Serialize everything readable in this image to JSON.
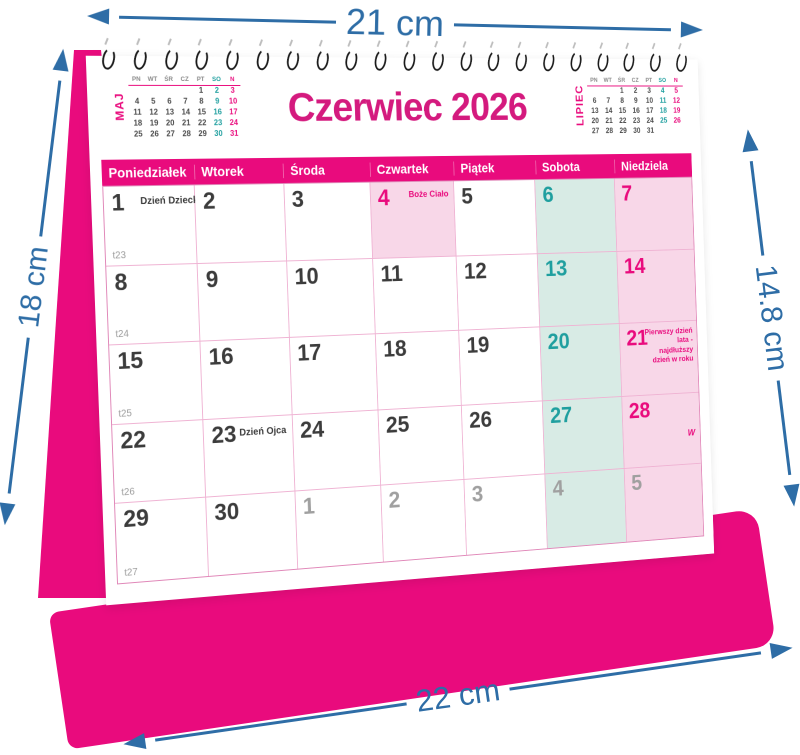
{
  "annotations": {
    "top": "21 cm",
    "left": "18 cm",
    "right": "14.8 cm",
    "bottom": "22 cm",
    "arrow_color": "#2e6da6"
  },
  "calendar": {
    "title": "Czerwiec 2026",
    "weekdays": [
      "Poniedziałek",
      "Wtorek",
      "Środa",
      "Czwartek",
      "Piątek",
      "Sobota",
      "Niedziela"
    ],
    "week_numbers": [
      "t23",
      "t24",
      "t25",
      "t26",
      "t27"
    ],
    "spiral_loops": 21,
    "mini_prev": {
      "label": "MAJ",
      "headers": [
        "PN",
        "WT",
        "ŚR",
        "CZ",
        "PT",
        "SO",
        "N"
      ],
      "days": [
        "",
        "",
        "",
        "",
        "1",
        "2",
        "3",
        "4",
        "5",
        "6",
        "7",
        "8",
        "9",
        "10",
        "11",
        "12",
        "13",
        "14",
        "15",
        "16",
        "17",
        "18",
        "19",
        "20",
        "21",
        "22",
        "23",
        "24",
        "25",
        "26",
        "27",
        "28",
        "29",
        "30",
        "31"
      ]
    },
    "mini_next": {
      "label": "LIPIEC",
      "headers": [
        "PN",
        "WT",
        "ŚR",
        "CZ",
        "PT",
        "SO",
        "N"
      ],
      "days": [
        "",
        "",
        "1",
        "2",
        "3",
        "4",
        "5",
        "6",
        "7",
        "8",
        "9",
        "10",
        "11",
        "12",
        "13",
        "14",
        "15",
        "16",
        "17",
        "18",
        "19",
        "20",
        "21",
        "22",
        "23",
        "24",
        "25",
        "26",
        "27",
        "28",
        "29",
        "30",
        "31",
        "",
        ""
      ]
    },
    "cells": [
      {
        "day": "1",
        "variant": "default",
        "week": "t23",
        "note": "Dzień Dziecka",
        "note_style": "dark"
      },
      {
        "day": "2",
        "variant": "default"
      },
      {
        "day": "3",
        "variant": "default"
      },
      {
        "day": "4",
        "variant": "holiday",
        "note": "Boże Ciało",
        "note_style": "pink"
      },
      {
        "day": "5",
        "variant": "default"
      },
      {
        "day": "6",
        "variant": "sat"
      },
      {
        "day": "7",
        "variant": "sun"
      },
      {
        "day": "8",
        "variant": "default",
        "week": "t24"
      },
      {
        "day": "9",
        "variant": "default"
      },
      {
        "day": "10",
        "variant": "default"
      },
      {
        "day": "11",
        "variant": "default"
      },
      {
        "day": "12",
        "variant": "default"
      },
      {
        "day": "13",
        "variant": "sat"
      },
      {
        "day": "14",
        "variant": "sun"
      },
      {
        "day": "15",
        "variant": "default",
        "week": "t25"
      },
      {
        "day": "16",
        "variant": "default"
      },
      {
        "day": "17",
        "variant": "default"
      },
      {
        "day": "18",
        "variant": "default"
      },
      {
        "day": "19",
        "variant": "default"
      },
      {
        "day": "20",
        "variant": "sat"
      },
      {
        "day": "21",
        "variant": "sun",
        "note": "Pierwszy dzień lata - najdłuższy dzień w roku",
        "note_style": "pink-block"
      },
      {
        "day": "22",
        "variant": "default",
        "week": "t26"
      },
      {
        "day": "23",
        "variant": "default",
        "note": "Dzień Ojca",
        "note_style": "dark"
      },
      {
        "day": "24",
        "variant": "default"
      },
      {
        "day": "25",
        "variant": "default"
      },
      {
        "day": "26",
        "variant": "default"
      },
      {
        "day": "27",
        "variant": "sat"
      },
      {
        "day": "28",
        "variant": "sun",
        "mark": "W"
      },
      {
        "day": "29",
        "variant": "default",
        "week": "t27"
      },
      {
        "day": "30",
        "variant": "default"
      },
      {
        "day": "1",
        "variant": "gray"
      },
      {
        "day": "2",
        "variant": "gray"
      },
      {
        "day": "3",
        "variant": "gray"
      },
      {
        "day": "4",
        "variant": "gray-sat"
      },
      {
        "day": "5",
        "variant": "gray-sun"
      }
    ],
    "colors": {
      "magenta": "#e90b7d",
      "title_pink": "#d41a7e",
      "teal": "#1f9f9f",
      "saturday_bg": "#d8ebe5",
      "sunday_bg": "#f8d7e8",
      "gray_day": "#a0a0a0"
    }
  }
}
